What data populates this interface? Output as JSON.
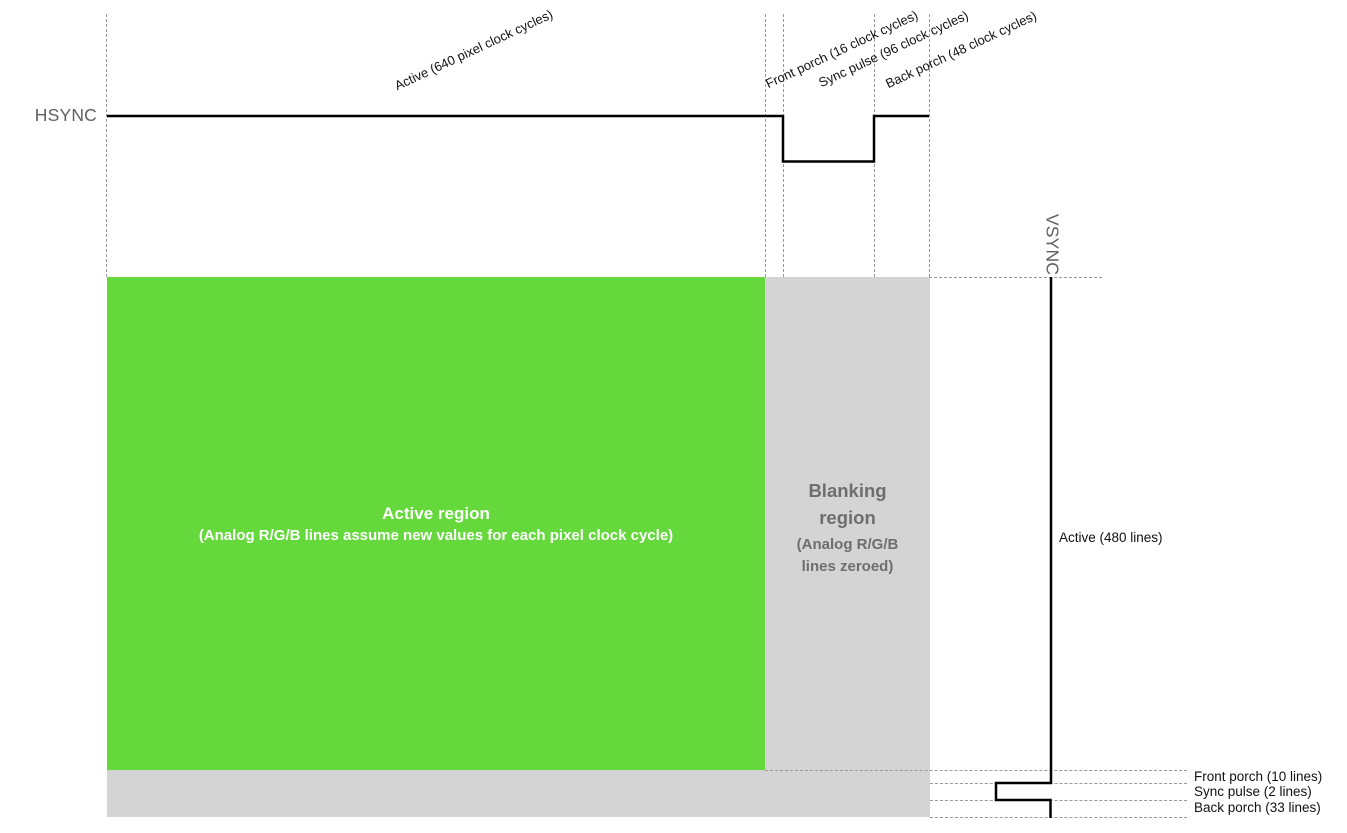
{
  "diagram": {
    "title_semantic": "VGA 640x480 timing diagram",
    "hsync": {
      "signal_label": "HSYNC",
      "segments": [
        {
          "name": "active",
          "label": "Active (640 pixel clock cycles)"
        },
        {
          "name": "front_porch",
          "label": "Front porch (16 clock cycles)"
        },
        {
          "name": "sync_pulse",
          "label": "Sync pulse (96 clock cycles)"
        },
        {
          "name": "back_porch",
          "label": "Back porch (48 clock cycles)"
        }
      ]
    },
    "vsync": {
      "signal_label": "VSYNC",
      "segments": [
        {
          "name": "active",
          "label": "Active (480 lines)"
        },
        {
          "name": "front_porch",
          "label": "Front porch (10 lines)"
        },
        {
          "name": "sync_pulse",
          "label": "Sync pulse (2 lines)"
        },
        {
          "name": "back_porch",
          "label": "Back porch (33 lines)"
        }
      ]
    },
    "regions": {
      "active": {
        "title": "Active region",
        "subtitle": "(Analog R/G/B lines assume new values for each pixel clock cycle)"
      },
      "blanking": {
        "title_line1": "Blanking",
        "title_line2": "region",
        "subtitle_line1": "(Analog R/G/B",
        "subtitle_line2": "lines zeroed)"
      }
    },
    "colors": {
      "active_region": "#65d93c",
      "blanking_region": "#d4d4d4",
      "active_region_text": "#ffffff",
      "blanking_text": "#6e6e6e",
      "signal_line": "#000000",
      "guide_line": "#999999",
      "signal_label_text": "#5f5f5f"
    }
  }
}
